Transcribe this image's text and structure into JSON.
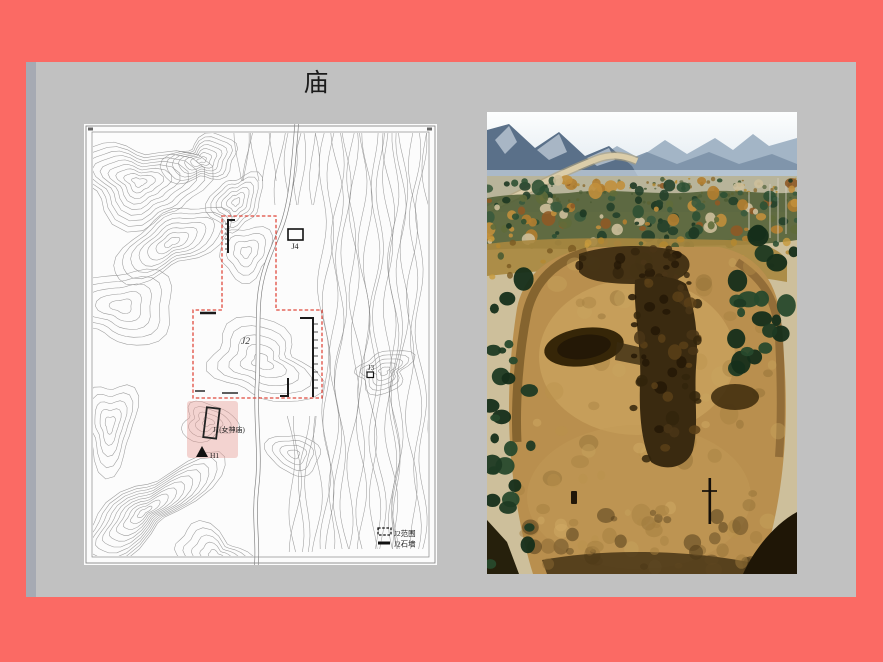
{
  "slide": {
    "title": "庙",
    "background_color": "#c1c1c1",
    "frame_color": "#fb6a64",
    "edge_strip_color": "#a6aab3"
  },
  "map": {
    "labels": {
      "j2": "J2",
      "j3": "J3",
      "j4": "J4",
      "j1": "J1(女神庙)",
      "h1": "H1"
    },
    "legend": {
      "range": {
        "label": "J2范围",
        "symbol": "dashed-rect"
      },
      "wall": {
        "label": "J2石墙",
        "symbol": "solid-line"
      }
    },
    "boundary_color": "#e0493d",
    "highlight_color": "#e89b94",
    "contour_color": "#8b8b8b"
  },
  "photo": {
    "kind": "aerial-excavation-photo"
  }
}
